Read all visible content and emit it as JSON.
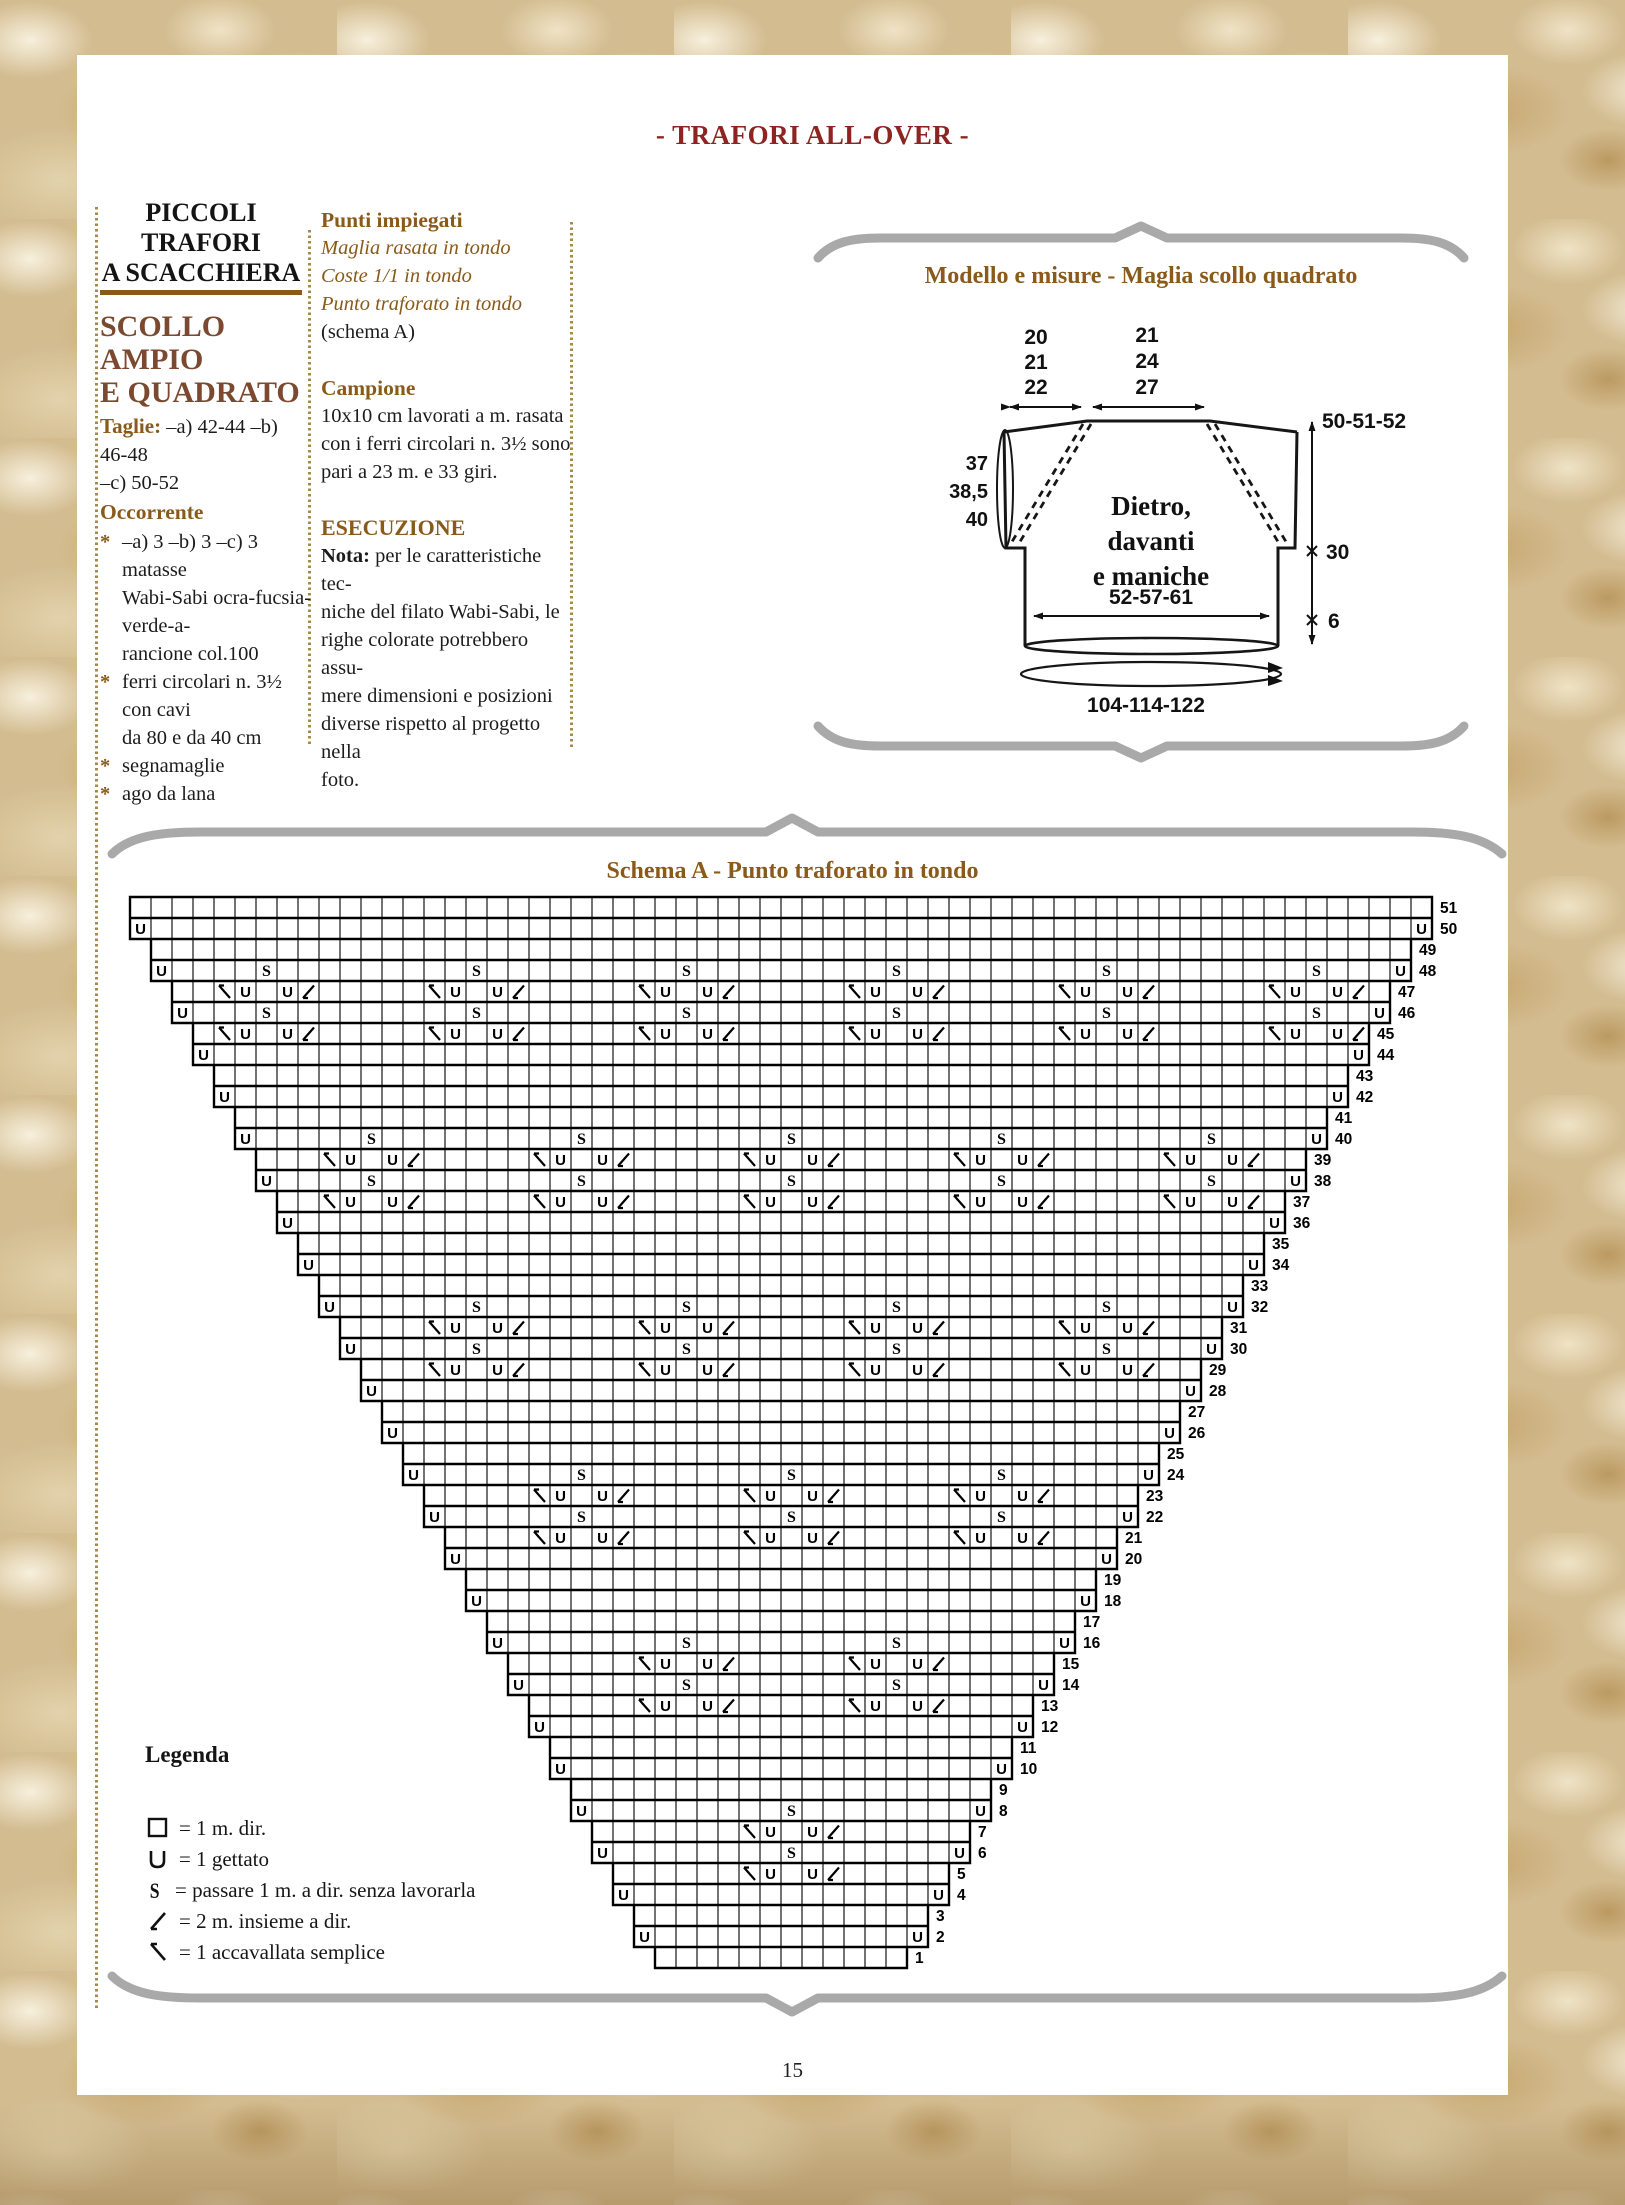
{
  "header": {
    "title": "- TRAFORI ALL-OVER -",
    "page_number": "15"
  },
  "left_column": {
    "title_lines": [
      "PICCOLI TRAFORI",
      "A SCACCHIERA"
    ],
    "subtitle_lines": [
      "SCOLLO AMPIO",
      "E QUADRATO"
    ],
    "taglie_label": "Taglie:",
    "taglie_text": " –a) 42-44 –b) 46-48",
    "taglie_line2": "–c) 50-52",
    "occorrente_title": "Occorrente",
    "bullet": "*",
    "items": [
      {
        "lines": [
          "–a) 3 –b) 3 –c) 3 matasse",
          "Wabi-Sabi ocra-fucsia-verde-a-",
          "rancione col.100"
        ]
      },
      {
        "lines": [
          "ferri circolari n. 3½ con cavi",
          "da 80 e da 40 cm"
        ]
      },
      {
        "lines": [
          "segnamaglie"
        ]
      },
      {
        "lines": [
          "ago da lana"
        ]
      }
    ]
  },
  "middle_column": {
    "punti_title": "Punti impiegati",
    "punti_lines": [
      "Maglia rasata in tondo",
      "Coste 1/1 in tondo",
      "Punto traforato in tondo"
    ],
    "schema_ref": "(schema A)",
    "campione_title": "Campione",
    "campione_lines": [
      "10x10 cm lavorati a m. rasata",
      "con i ferri circolari n. 3½ sono",
      "pari a 23 m. e 33 giri."
    ],
    "esecuzione_title": "ESECUZIONE",
    "nota_label": "Nota:",
    "nota_first": " per le caratteristiche tec-",
    "nota_lines": [
      "niche del filato Wabi-Sabi, le",
      "righe colorate potrebbero assu-",
      "mere dimensioni e posizioni",
      "diverse rispetto al progetto nella",
      "foto."
    ]
  },
  "modello": {
    "title": "Modello e misure - Maglia scollo quadrato",
    "left_stack": [
      "20",
      "21",
      "22"
    ],
    "mid_stack": [
      "21",
      "24",
      "27"
    ],
    "right_top": "50-51-52",
    "mid_right": "30",
    "hem_height": "6",
    "sleeve_stack": [
      "37",
      "38,5",
      "40"
    ],
    "chest": "52-57-61",
    "circumference": "104-114-122",
    "body_lines": [
      "Dietro,",
      "davanti",
      "e maniche"
    ]
  },
  "schema": {
    "title": "Schema A - Punto traforato in tondo"
  },
  "chart_data": {
    "type": "knitting-chart",
    "title": "Schema A - Punto traforato in tondo",
    "rows": 51,
    "max_cols": 62,
    "bottom_row_stitches": 12,
    "top_row_stitches": 62,
    "row_labels_range": "1 (bottom) to 51 (top), printed at the right edge of every row",
    "shaping": "rows are paired (even row + odd row above it share width); each even row adds one stitch at both edges with a yarn-over, so the piece widens by 2 sts every 2 rows from 12 sts (row 1) to 62 sts (row 51)",
    "edge_symbol": "U (yarn-over) in the first and last cell of every even row 2–50",
    "motif": [
      "skp",
      "yo",
      "k1",
      "yo",
      "k2tog"
    ],
    "block_row_roles": "within each 4-row lace block (listed top to bottom): rows 1 and 3 carry S above/below motif centres plus edge yarn-overs; rows 2 and 4 carry the motif skp-U-_-U-k2tog centred on the same columns",
    "blocks": [
      {
        "rows": [
          48,
          47,
          46,
          45
        ],
        "centers": [
          6,
          16,
          26,
          36,
          46,
          56
        ]
      },
      {
        "rows": [
          40,
          39,
          38,
          37
        ],
        "centers": [
          11,
          21,
          31,
          41,
          51
        ]
      },
      {
        "rows": [
          32,
          31,
          30,
          29
        ],
        "centers": [
          16,
          26,
          36,
          46
        ]
      },
      {
        "rows": [
          24,
          23,
          22,
          21
        ],
        "centers": [
          21,
          31,
          41
        ]
      },
      {
        "rows": [
          16,
          15,
          14,
          13
        ],
        "centers": [
          26,
          36
        ]
      },
      {
        "rows": [
          8,
          7,
          6,
          5
        ],
        "centers": [
          31
        ]
      }
    ],
    "symbols": {
      "empty": "1 m. dir.",
      "yo": "U",
      "slip": "S",
      "k2tog": "/",
      "skp": "\\"
    },
    "cell": 21,
    "origin_x": 130,
    "origin_y": 897
  },
  "legend": {
    "title": "Legenda",
    "items": [
      {
        "sym": "square",
        "text": "= 1 m. dir."
      },
      {
        "sym": "yo",
        "text": "= 1 gettato"
      },
      {
        "sym": "slip",
        "text": "= passare 1 m. a dir. senza lavorarla"
      },
      {
        "sym": "k2tog",
        "text": "= 2 m. insieme a dir."
      },
      {
        "sym": "skp",
        "text": "= 1 accavallata semplice"
      }
    ]
  }
}
